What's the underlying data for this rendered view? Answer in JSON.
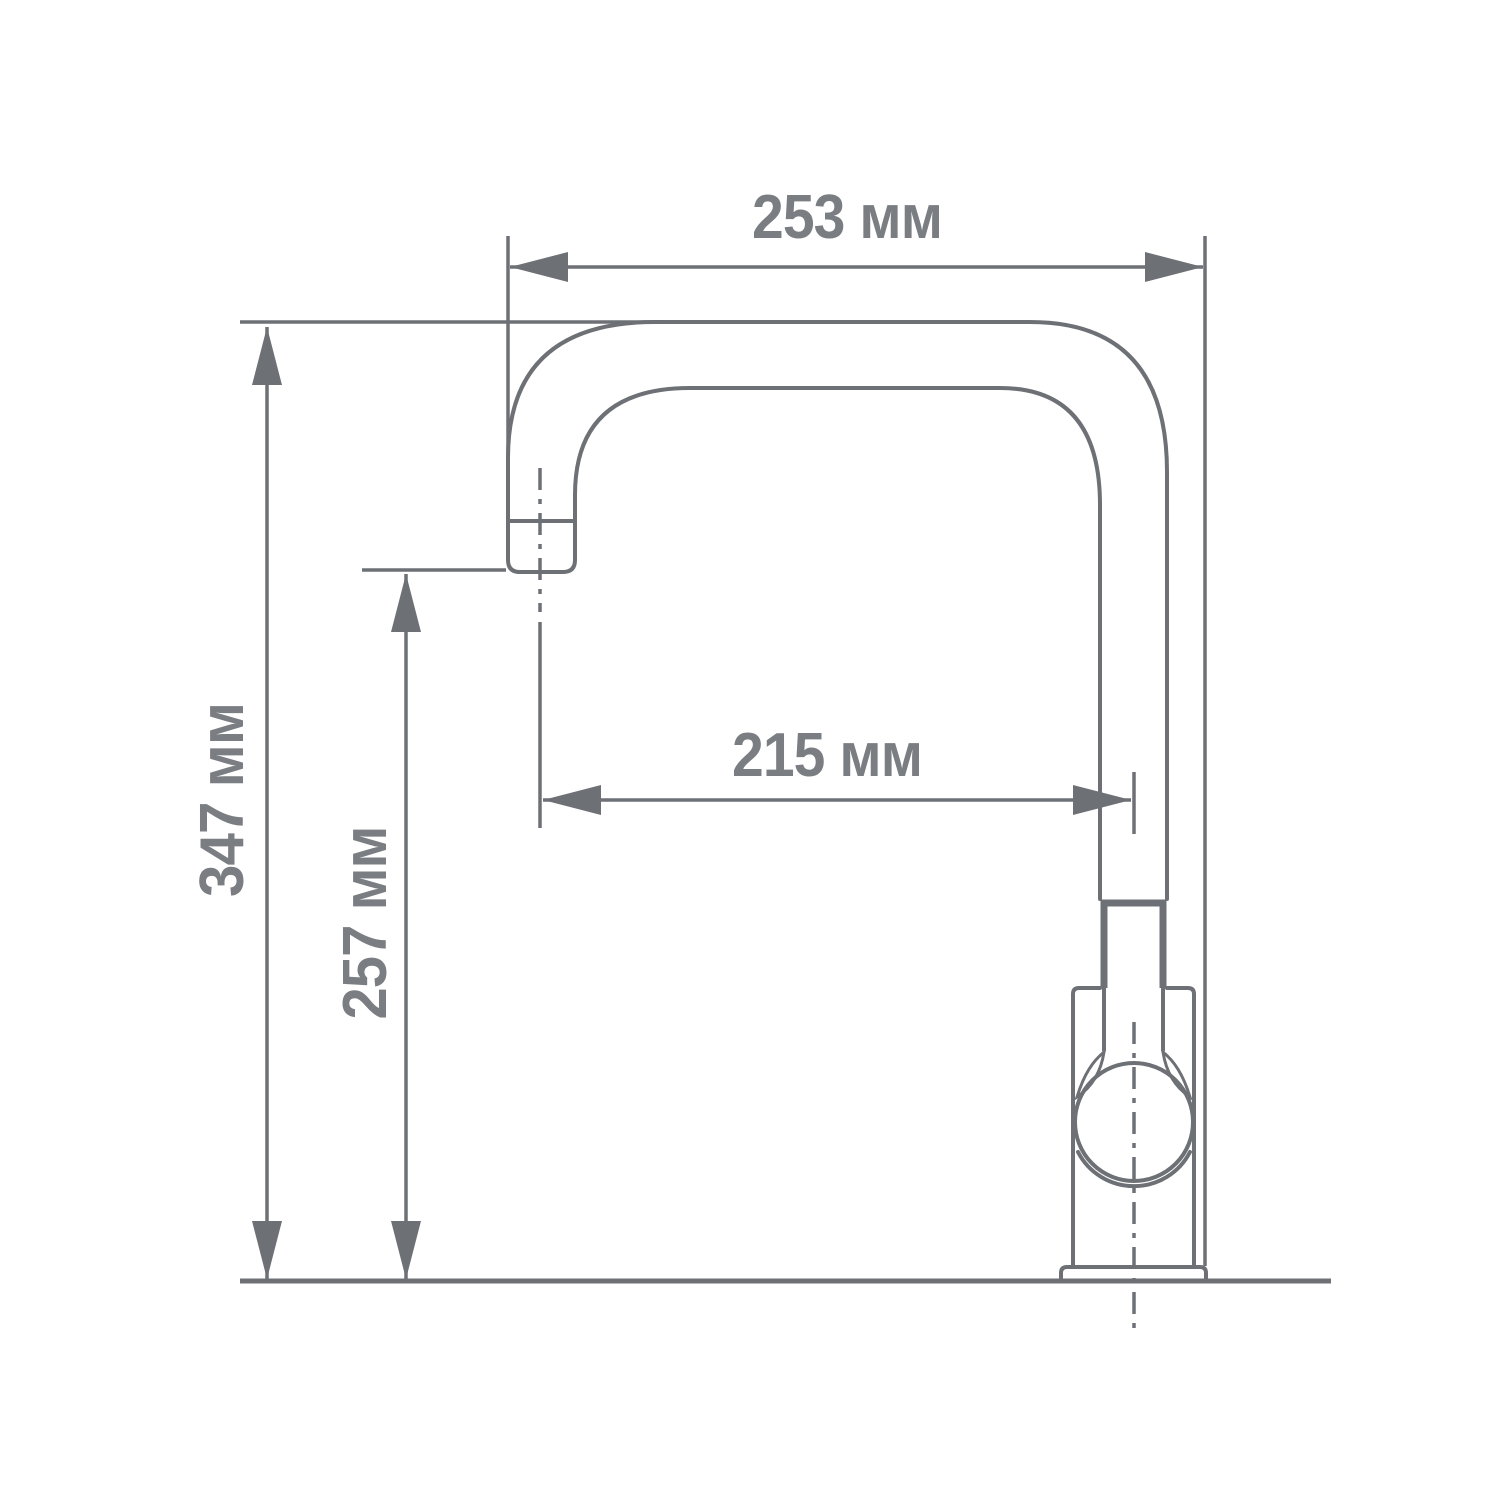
{
  "drawing": {
    "unit_suffix": "мм",
    "colors": {
      "line": "#6d7176",
      "text": "#7a7d81",
      "background": "#ffffff"
    },
    "dimensions": {
      "total_width": {
        "label": "253 мм",
        "value_mm": 253,
        "orientation": "horizontal"
      },
      "total_height": {
        "label": "347 мм",
        "value_mm": 347,
        "orientation": "vertical"
      },
      "spout_height": {
        "label": "257 мм",
        "value_mm": 257,
        "orientation": "vertical"
      },
      "spout_reach": {
        "label": "215 мм",
        "value_mm": 215,
        "orientation": "horizontal"
      }
    }
  }
}
